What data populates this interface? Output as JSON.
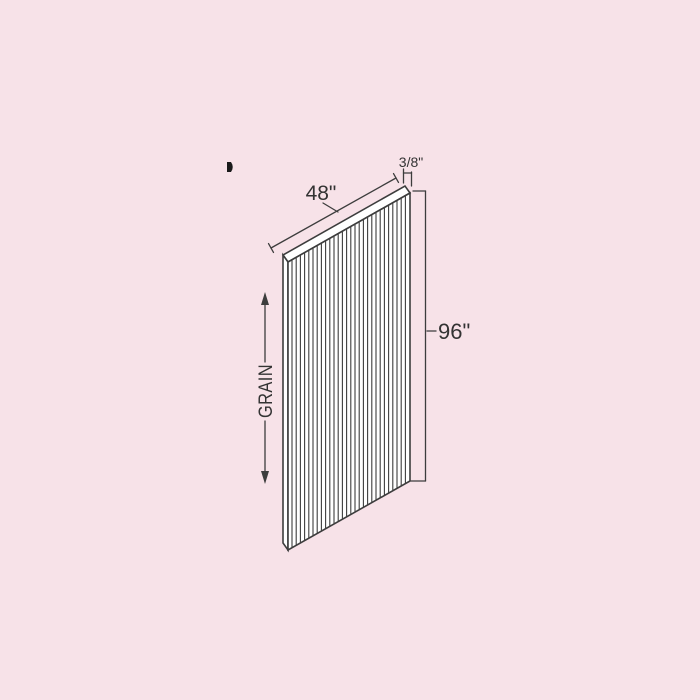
{
  "colors": {
    "background": "#f7e2e8",
    "line_color": "#3d3d3d",
    "text_color": "#333333",
    "edge_mark_color": "#1a1a1a"
  },
  "diagram": {
    "type": "cabinet-panel-technical-drawing",
    "labels": {
      "width_dim": "48\"",
      "thickness_dim": "3/8\"",
      "height_dim": "96\"",
      "grain_label": "GRAIN"
    }
  }
}
